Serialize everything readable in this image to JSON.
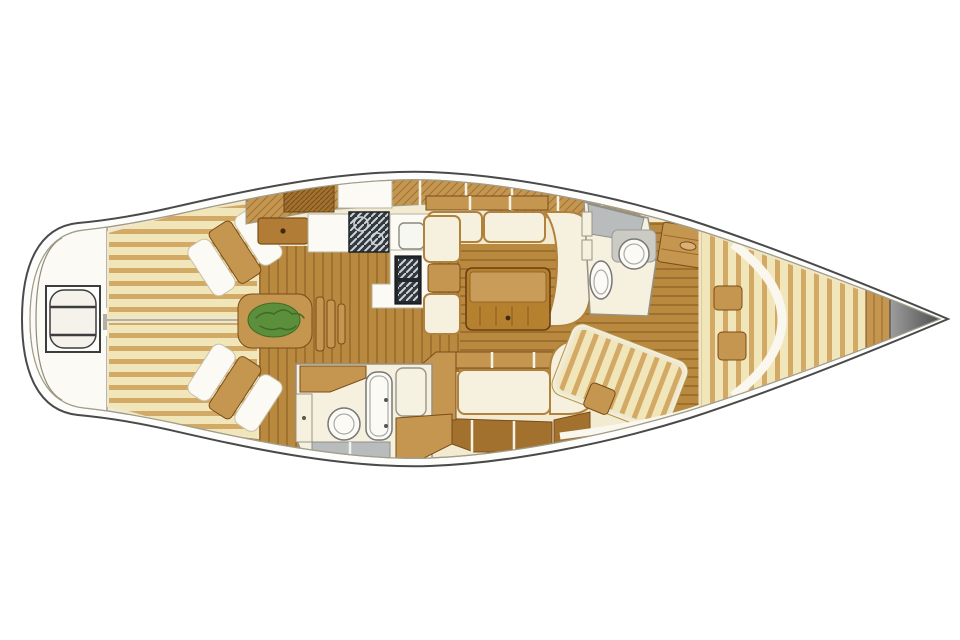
{
  "figure": {
    "kind": "sailing-yacht-interior-floor-plan",
    "view": "overhead",
    "bow_direction": "right",
    "visible_text": [],
    "areas": [
      "swim-platform-stern",
      "aft-cabin-port",
      "aft-cabin-starboard",
      "engine-compartment",
      "companionway-steps",
      "galley",
      "saloon-dinette",
      "saloon-table",
      "starboard-settee",
      "aft-head",
      "forward-head",
      "forward-cabin",
      "v-berth",
      "bow-bulkhead",
      "anchor-locker"
    ],
    "fixtures": [
      "swim-ladder",
      "stove",
      "sink",
      "fridge",
      "drawer",
      "toilet",
      "wash-basin",
      "shower-floor",
      "berth-pillows",
      "plant-on-steps",
      "dining-table"
    ]
  },
  "colors": {
    "page_bg": "#ffffff",
    "hull_fill": "#fdfdfb",
    "outline": "#4a4a4a",
    "deck": "#f2ead1",
    "deck_line": "#a29c8a",
    "stripe_light": "#f1e5ba",
    "stripe_dark": "#d3a966",
    "floor": "#b8893f",
    "floor_line": "#8f6224",
    "wood": "#c4964f",
    "wood_dark": "#a3712e",
    "wood_stroke": "#7a4c18",
    "drawer": "#b07c36",
    "cream": "#f5f1de",
    "white": "#fbfaf4",
    "cushion_trim": "#b0823c",
    "gray": "#b5b0a6",
    "shower_gray": "#b9bcbc",
    "steel_dark": "#33383e",
    "steel_light": "#cfd6da",
    "green": "#5c8f3b",
    "green_dark": "#3f6b26"
  }
}
